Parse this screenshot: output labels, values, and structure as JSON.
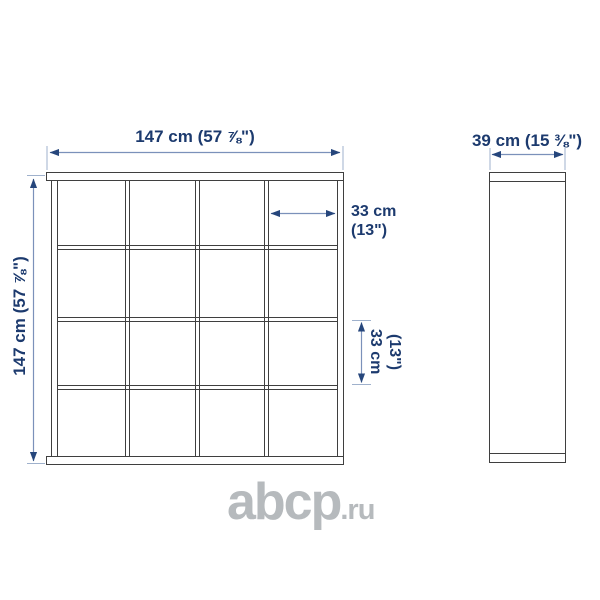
{
  "product_diagram": {
    "type": "shelving-unit-dimension-drawing",
    "front_view": {
      "grid_rows": 4,
      "grid_cols": 4,
      "width_dimension": "147 cm (57 ⅞\")",
      "height_dimension": "147 cm (57 ⅞\")",
      "cell_width_dimension": {
        "line1": "33 cm",
        "line2": "(13\")"
      },
      "cell_height_dimension": {
        "line1": "33 cm",
        "line2": "(13\")"
      }
    },
    "side_view": {
      "depth_dimension": "39 cm (15 ⅜\")"
    }
  },
  "watermark": {
    "main": "abcp",
    "suffix": ".ru"
  },
  "colors": {
    "background": "#ffffff",
    "outline": "#3f3f3f",
    "dimension_text": "#1c3a6e",
    "dimension_line": "#7b91ba",
    "extension_line": "#9fb1cc",
    "arrowhead": "#26467c",
    "watermark": "#b6babd"
  }
}
